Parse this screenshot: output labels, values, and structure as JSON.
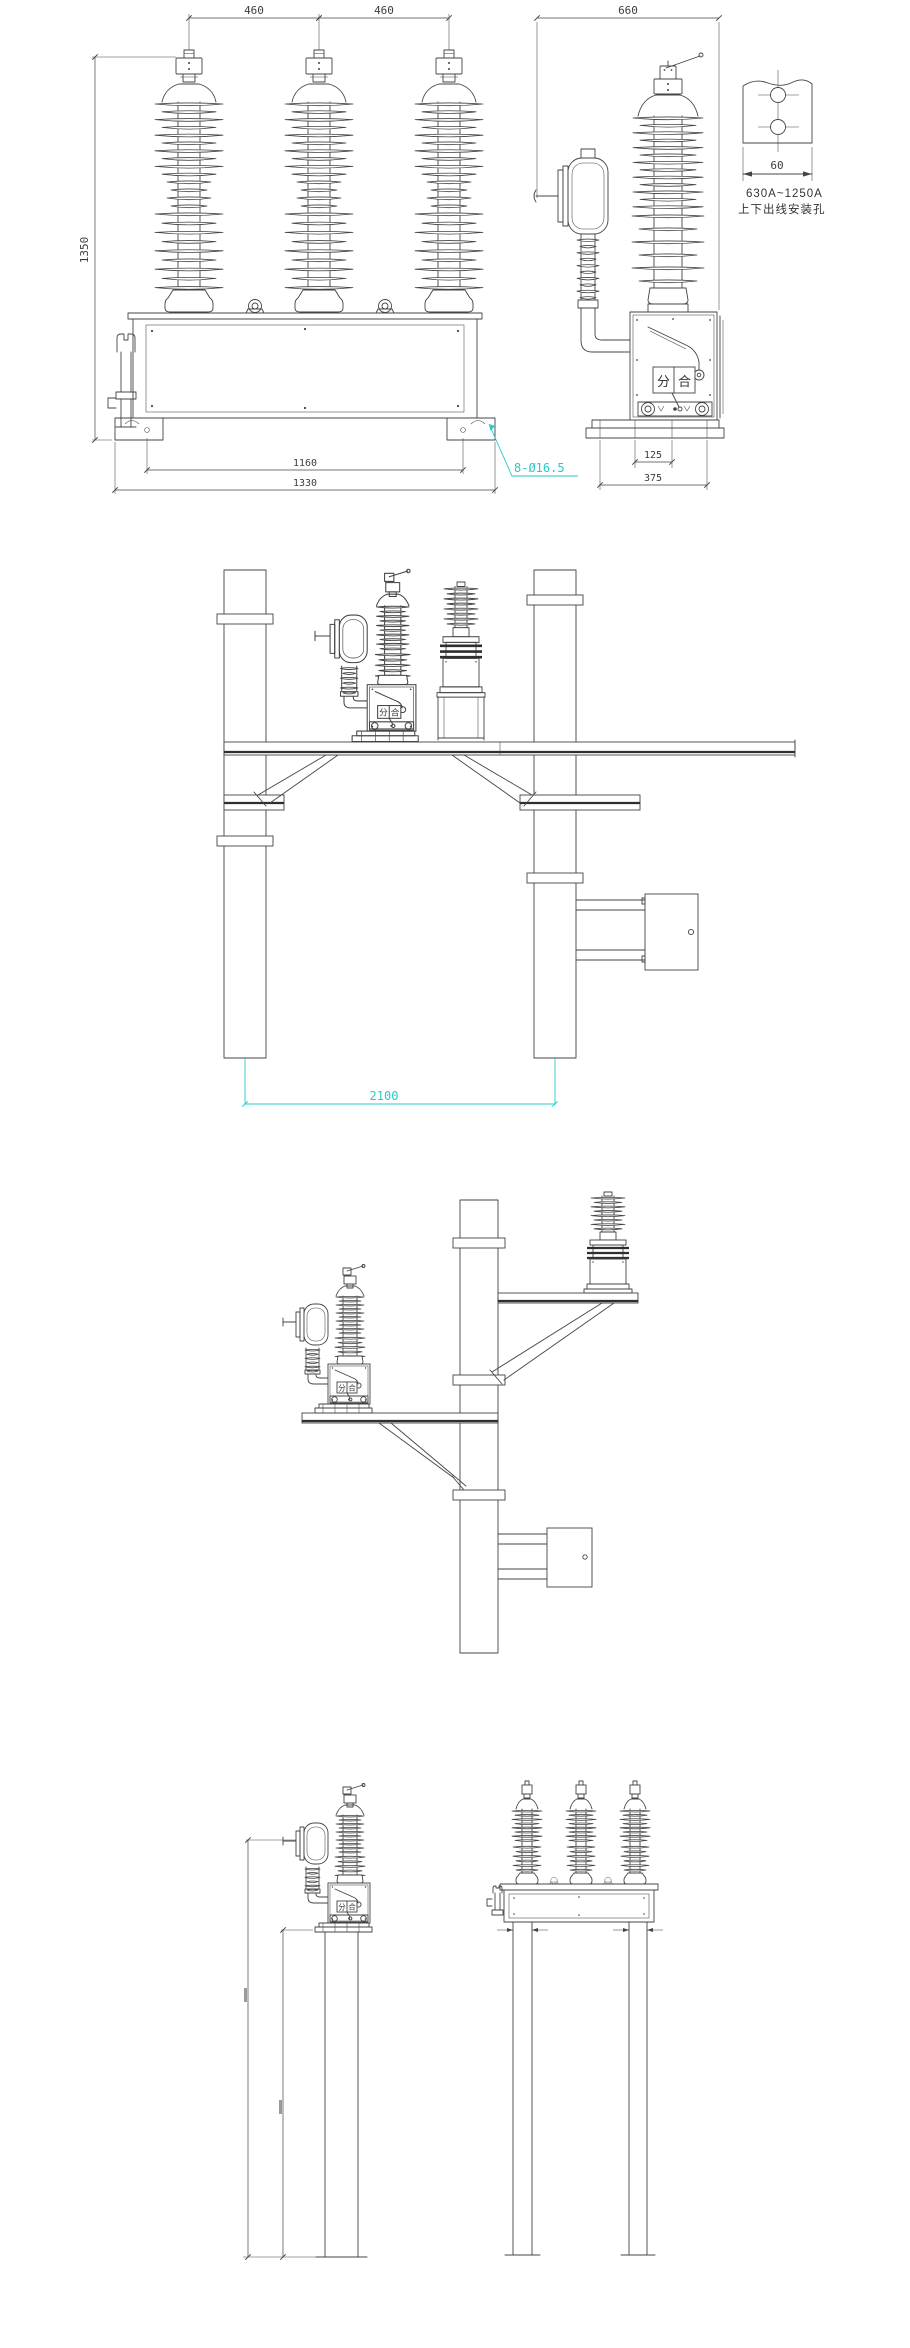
{
  "page": {
    "background": "#ffffff",
    "line_color": "#444444",
    "accent_cyan": "#2BC8C8"
  },
  "front_view": {
    "dim_460_left": "460",
    "dim_460_right": "460",
    "dim_1350": "1350",
    "dim_1160": "1160",
    "dim_1330": "1330",
    "mounting_holes_note": "8-Ø16.5"
  },
  "side_view": {
    "dim_660": "660",
    "dim_125": "125",
    "dim_375": "375",
    "indicator_open": "分",
    "indicator_close": "合"
  },
  "terminal_detail": {
    "dim_60": "60",
    "current_rating": "630A~1250A",
    "caption": "上下出线安装孔"
  },
  "double_pole_view": {
    "dim_2100": "2100"
  },
  "breaker_symbol": {
    "indicator_open": "分",
    "indicator_close": "合"
  }
}
